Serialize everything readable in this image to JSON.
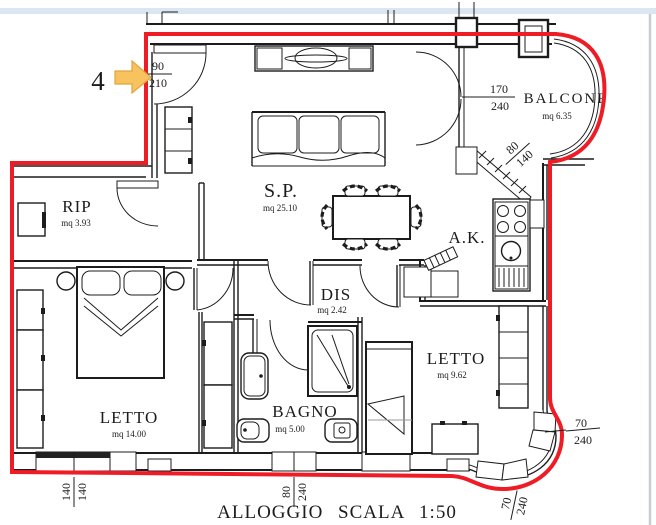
{
  "window": {
    "top_band_color": "#dce6f3",
    "edge_color": "#c9ced6"
  },
  "title": "ALLOGGIO SCALA 1:50",
  "marker": {
    "number": "4"
  },
  "colors": {
    "outline": "#ee1c25",
    "arrow_fill": "#f8c35e",
    "arrow_stroke": "#e2a43d"
  },
  "rooms": {
    "rip": {
      "name": "RIP",
      "area": "mq 3.93"
    },
    "sp": {
      "name": "S.P.",
      "area": "mq 25.10"
    },
    "balcone": {
      "name": "BALCONE",
      "area": "mq 6.35"
    },
    "ak": {
      "name": "A.K."
    },
    "dis": {
      "name": "DIS",
      "area": "mq 2.42"
    },
    "letto1": {
      "name": "LETTO",
      "area": "mq 14.00"
    },
    "bagno": {
      "name": "BAGNO",
      "area": "mq 5.00"
    },
    "letto2": {
      "name": "LETTO",
      "area": "mq 9.62"
    }
  },
  "dims": {
    "entry_door": {
      "num": "90",
      "den": "210"
    },
    "balcony_door": {
      "num": "170",
      "den": "240"
    },
    "kitchen_window": {
      "num": "80",
      "den": "140"
    },
    "bed1_window": {
      "num": "140",
      "den": "140"
    },
    "bath_window": {
      "num": "80",
      "den": "240"
    },
    "bed2_window_side": {
      "num": "70",
      "den": "240"
    },
    "bed2_window_bottom": {
      "num": "70",
      "den": "240"
    }
  }
}
